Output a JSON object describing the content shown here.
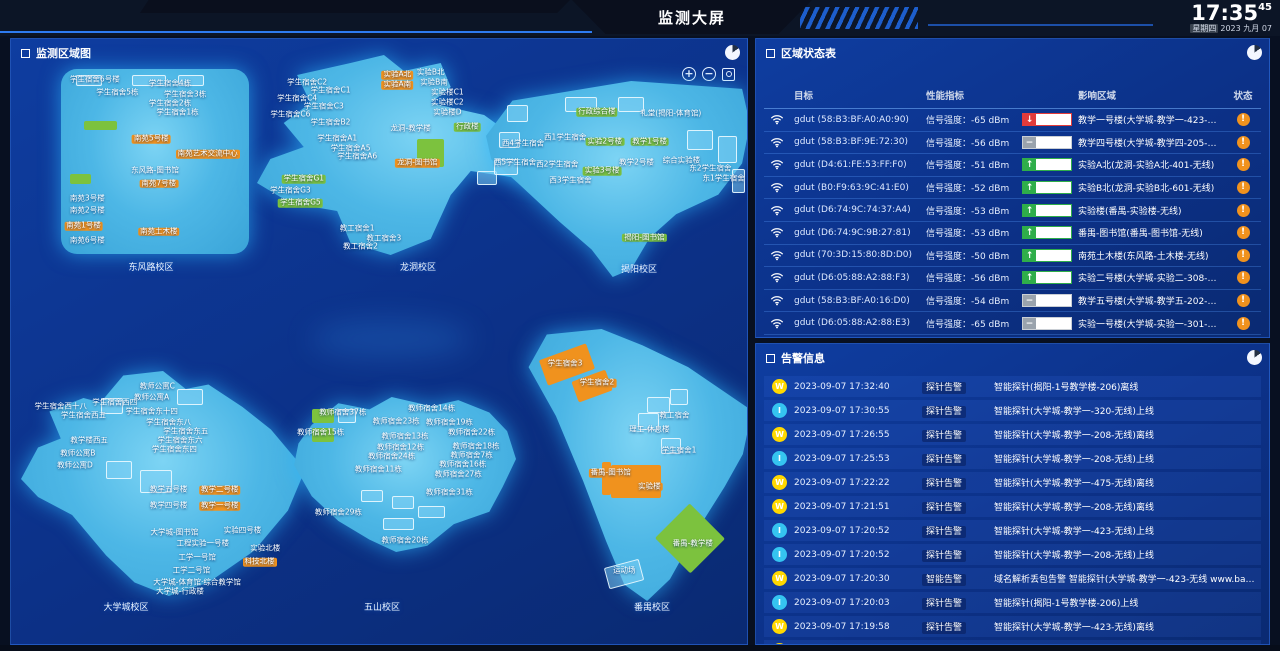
{
  "header": {
    "title": "监测大屏",
    "clock": {
      "time": "17:35",
      "seconds": "45",
      "weekday": "星期四",
      "date_rest": "2023 九月 07"
    }
  },
  "colors": {
    "orange": "#f0921e",
    "green": "#7cc23e",
    "alarm-w": "#ffd800",
    "alarm-i": "#35c4f0",
    "trend-red": "#e23b3b",
    "trend-green": "#2fae4a",
    "trend-gray": "#9aa3ad"
  },
  "map_panel": {
    "title": "监测区域图",
    "zoom_controls": {
      "zoom_in": "+",
      "zoom_out": "−",
      "fit": "fit-view"
    },
    "campuses": [
      {
        "name": "东风路校区",
        "label_pos": [
          140,
          221
        ],
        "labels": [
          [
            18,
            6,
            0,
            "学生宿舍6号楼"
          ],
          [
            58,
            8,
            0,
            "学生宿舍4栋"
          ],
          [
            30,
            13,
            0,
            "学生宿舍5栋"
          ],
          [
            66,
            14,
            0,
            "学生宿舍3栋"
          ],
          [
            58,
            19,
            0,
            "学生宿舍2栋"
          ],
          [
            62,
            24,
            0,
            "学生宿舍1栋"
          ],
          [
            48,
            38,
            1,
            "南苑5号楼"
          ],
          [
            78,
            46,
            1,
            "南苑艺术交流中心"
          ],
          [
            50,
            55,
            0,
            "东风路-图书馆"
          ],
          [
            52,
            62,
            1,
            "南苑7号楼"
          ],
          [
            14,
            70,
            0,
            "南苑3号楼"
          ],
          [
            14,
            77,
            0,
            "南苑2号楼"
          ],
          [
            12,
            85,
            1,
            "南苑1号楼"
          ],
          [
            14,
            93,
            0,
            "南苑6号楼"
          ],
          [
            52,
            88,
            1,
            "南苑土木楼"
          ]
        ],
        "rects": [
          [
            12,
            28,
            18,
            5,
            "gr"
          ],
          [
            5,
            57,
            11,
            5,
            "gr"
          ],
          [
            8,
            3,
            14,
            6,
            "o"
          ],
          [
            38,
            3,
            18,
            6,
            "o"
          ],
          [
            62,
            3,
            14,
            6,
            "o"
          ]
        ]
      },
      {
        "name": "龙洞校区",
        "label_pos": [
          407,
          221
        ],
        "labels": [
          [
            15,
            14,
            0,
            "学生宿舍C2"
          ],
          [
            22,
            18,
            0,
            "学生宿舍C1"
          ],
          [
            12,
            22,
            0,
            "学生宿舍C4"
          ],
          [
            20,
            26,
            0,
            "学生宿舍C3"
          ],
          [
            10,
            30,
            0,
            "学生宿舍C6"
          ],
          [
            42,
            10,
            1,
            "实验A北"
          ],
          [
            52,
            9,
            0,
            "实验B北"
          ],
          [
            42,
            15,
            1,
            "实验A南"
          ],
          [
            53,
            14,
            0,
            "实验B南"
          ],
          [
            57,
            19,
            0,
            "实验楼C1"
          ],
          [
            57,
            24,
            0,
            "实验楼C2"
          ],
          [
            57,
            29,
            0,
            "实验楼D"
          ],
          [
            22,
            34,
            0,
            "学生宿舍B2"
          ],
          [
            24,
            42,
            0,
            "学生宿舍A1"
          ],
          [
            28,
            47,
            0,
            "学生宿舍A5"
          ],
          [
            30,
            51,
            0,
            "学生宿舍A6"
          ],
          [
            46,
            37,
            0,
            "龙洞-教学楼"
          ],
          [
            63,
            36,
            2,
            "行政楼"
          ],
          [
            48,
            54,
            1,
            "龙洞-图书馆"
          ],
          [
            14,
            62,
            2,
            "学生宿舍G1"
          ],
          [
            10,
            68,
            0,
            "学生宿舍G3"
          ],
          [
            13,
            74,
            2,
            "学生宿舍G5"
          ],
          [
            30,
            87,
            0,
            "教工宿舍1"
          ],
          [
            38,
            92,
            0,
            "教工宿舍3"
          ],
          [
            31,
            96,
            0,
            "教工宿舍2"
          ]
        ],
        "rects": [
          [
            48,
            42,
            8,
            14,
            "gr"
          ],
          [
            72,
            48,
            7,
            8,
            "o"
          ],
          [
            81,
            52,
            7,
            8,
            "o"
          ],
          [
            89,
            58,
            6,
            7,
            "o"
          ],
          [
            66,
            58,
            6,
            7,
            "o"
          ]
        ]
      },
      {
        "name": "揭阳校区",
        "label_pos": [
          628,
          223
        ],
        "labels": [
          [
            42,
            16,
            2,
            "行政综合楼"
          ],
          [
            70,
            17,
            0,
            "礼堂(揭阳-体育馆)"
          ],
          [
            14,
            32,
            0,
            "西4学生宿舍"
          ],
          [
            30,
            29,
            0,
            "西1学生宿舍"
          ],
          [
            45,
            31,
            2,
            "实验2号楼"
          ],
          [
            62,
            31,
            2,
            "教学1号楼"
          ],
          [
            11,
            42,
            0,
            "西5学生宿舍"
          ],
          [
            27,
            43,
            0,
            "西2学生宿舍"
          ],
          [
            44,
            46,
            2,
            "实验3号楼"
          ],
          [
            57,
            42,
            0,
            "教学2号楼"
          ],
          [
            74,
            41,
            0,
            "综合实验楼"
          ],
          [
            85,
            45,
            0,
            "东2学生宿舍"
          ],
          [
            90,
            50,
            0,
            "东1学生宿舍"
          ],
          [
            32,
            51,
            0,
            "西3学生宿舍"
          ],
          [
            60,
            80,
            2,
            "揭阳-图书馆"
          ]
        ],
        "rects": [
          [
            8,
            12,
            8,
            9,
            "o"
          ],
          [
            5,
            26,
            8,
            8,
            "o"
          ],
          [
            3,
            40,
            9,
            8,
            "o"
          ],
          [
            30,
            8,
            12,
            8,
            "o"
          ],
          [
            50,
            8,
            10,
            8,
            "o"
          ],
          [
            76,
            25,
            10,
            10,
            "o"
          ],
          [
            88,
            28,
            7,
            14,
            "o"
          ],
          [
            93,
            45,
            5,
            12,
            "o"
          ]
        ]
      },
      {
        "name": "大学城校区",
        "label_pos": [
          115,
          561
        ],
        "labels": [
          [
            48,
            7,
            0,
            "教师公寓C"
          ],
          [
            46,
            12,
            0,
            "教师公寓A"
          ],
          [
            14,
            16,
            0,
            "学生宿舍西十八"
          ],
          [
            33,
            14,
            0,
            "学生宿舍西四"
          ],
          [
            22,
            20,
            0,
            "学生宿舍西五"
          ],
          [
            46,
            18,
            0,
            "学生宿舍东十四"
          ],
          [
            52,
            23,
            0,
            "学生宿舍东八"
          ],
          [
            58,
            27,
            0,
            "学生宿舍东五"
          ],
          [
            56,
            31,
            0,
            "学生宿舍东六"
          ],
          [
            54,
            35,
            0,
            "学生宿舍东四"
          ],
          [
            24,
            31,
            0,
            "教学楼西五"
          ],
          [
            20,
            37,
            0,
            "教师公寓B"
          ],
          [
            19,
            42,
            0,
            "教师公寓D"
          ],
          [
            52,
            53,
            0,
            "教学五号楼"
          ],
          [
            70,
            53,
            1,
            "教学二号楼"
          ],
          [
            52,
            60,
            0,
            "教学四号楼"
          ],
          [
            70,
            60,
            1,
            "教学一号楼"
          ],
          [
            54,
            72,
            0,
            "大学城-图书馆"
          ],
          [
            78,
            71,
            0,
            "实验四号楼"
          ],
          [
            64,
            77,
            0,
            "工程实验一号楼"
          ],
          [
            86,
            79,
            0,
            "实验北楼"
          ],
          [
            62,
            83,
            0,
            "工学一号馆"
          ],
          [
            84,
            85,
            1,
            "科技北楼"
          ],
          [
            60,
            89,
            0,
            "工学二号馆"
          ],
          [
            62,
            94,
            0,
            "大学城-体育馆·综合教学馆"
          ],
          [
            56,
            98,
            0,
            "大学城-行政楼"
          ]
        ],
        "rects": [
          [
            28,
            12,
            8,
            7,
            "o"
          ],
          [
            55,
            8,
            9,
            7,
            "o"
          ],
          [
            30,
            40,
            9,
            8,
            "o"
          ],
          [
            42,
            44,
            11,
            10,
            "o"
          ]
        ]
      },
      {
        "name": "五山校区",
        "label_pos": [
          371,
          561
        ],
        "labels": [
          [
            22,
            10,
            0,
            "教师宿舍37栋"
          ],
          [
            62,
            8,
            0,
            "教师宿舍14栋"
          ],
          [
            46,
            16,
            0,
            "教师宿舍23栋"
          ],
          [
            70,
            17,
            0,
            "教师宿舍19栋"
          ],
          [
            12,
            23,
            0,
            "教师宿舍15栋"
          ],
          [
            80,
            23,
            0,
            "教师宿舍22栋"
          ],
          [
            50,
            26,
            0,
            "教师宿舍13栋"
          ],
          [
            48,
            33,
            0,
            "教师宿舍12栋"
          ],
          [
            82,
            32,
            0,
            "教师宿舍18栋"
          ],
          [
            44,
            39,
            0,
            "教师宿舍24栋"
          ],
          [
            80,
            38,
            0,
            "教师宿舍7栋"
          ],
          [
            76,
            44,
            0,
            "教师宿舍16栋"
          ],
          [
            38,
            47,
            0,
            "教师宿舍11栋"
          ],
          [
            74,
            50,
            0,
            "教师宿舍27栋"
          ],
          [
            70,
            62,
            0,
            "教师宿舍31栋"
          ],
          [
            20,
            75,
            0,
            "教师宿舍29栋"
          ],
          [
            50,
            93,
            0,
            "教师宿舍20栋"
          ]
        ],
        "rects": [
          [
            8,
            8,
            10,
            9,
            "gr"
          ],
          [
            8,
            20,
            10,
            9,
            "gr"
          ],
          [
            20,
            8,
            8,
            9,
            "o"
          ],
          [
            30,
            60,
            10,
            8,
            "o"
          ],
          [
            44,
            64,
            10,
            8,
            "o"
          ],
          [
            56,
            70,
            12,
            8,
            "o"
          ],
          [
            40,
            78,
            14,
            8,
            "o"
          ]
        ]
      },
      {
        "name": "番禺校区",
        "label_pos": [
          641,
          561
        ],
        "labels": [
          [
            18,
            13,
            1,
            "学生宿舍3"
          ],
          [
            32,
            20,
            1,
            "学生宿舍2"
          ],
          [
            66,
            32,
            0,
            "教工宿舍"
          ],
          [
            55,
            37,
            0,
            "理工-休息楼"
          ],
          [
            68,
            45,
            0,
            "学生宿舍1"
          ],
          [
            38,
            53,
            1,
            "番禺-图书馆"
          ],
          [
            55,
            58,
            1,
            "实验楼"
          ],
          [
            74,
            79,
            2,
            "番禺-教学楼"
          ],
          [
            44,
            89,
            0,
            "运动场"
          ]
        ],
        "rects": [
          [
            8,
            8,
            22,
            10,
            "or",
            -20
          ],
          [
            22,
            17,
            16,
            8,
            "or",
            -20
          ],
          [
            38,
            50,
            22,
            12,
            "or",
            0
          ],
          [
            34,
            49,
            4,
            12,
            "or",
            0
          ],
          [
            62,
            68,
            22,
            18,
            "grd",
            0
          ],
          [
            54,
            25,
            10,
            6,
            "o"
          ],
          [
            64,
            22,
            8,
            6,
            "o"
          ],
          [
            50,
            31,
            9,
            6,
            "o"
          ],
          [
            60,
            40,
            9,
            6,
            "o"
          ],
          [
            36,
            86,
            16,
            8,
            "o",
            -15
          ]
        ]
      }
    ]
  },
  "status_panel": {
    "title": "区域状态表",
    "columns": [
      "目标",
      "性能指标",
      "影响区域",
      "状态"
    ],
    "rows": [
      {
        "target": "gdut (58:B3:BF:A0:A0:90)",
        "metric": "信号强度：-65 dBm",
        "trend": "down",
        "area": "教学一号楼(大学城-教学一-423-无线)",
        "status": "warning"
      },
      {
        "target": "gdut (58:B3:BF:9E:72:30)",
        "metric": "信号强度：-56 dBm",
        "trend": "flat",
        "area": "教学四号楼(大学城-教学四-205-无线)",
        "status": "warning"
      },
      {
        "target": "gdut (D4:61:FE:53:FF:F0)",
        "metric": "信号强度：-51 dBm",
        "trend": "up",
        "area": "实验A北(龙洞-实验A北-401-无线)",
        "status": "warning"
      },
      {
        "target": "gdut (B0:F9:63:9C:41:E0)",
        "metric": "信号强度：-52 dBm",
        "trend": "up",
        "area": "实验B北(龙洞-实验B北-601-无线)",
        "status": "warning"
      },
      {
        "target": "gdut (D6:74:9C:74:37:A4)",
        "metric": "信号强度：-53 dBm",
        "trend": "up",
        "area": "实验楼(番禺-实验楼-无线)",
        "status": "warning"
      },
      {
        "target": "gdut (D6:74:9C:9B:27:81)",
        "metric": "信号强度：-53 dBm",
        "trend": "up",
        "area": "番禺-图书馆(番禺-图书馆-无线)",
        "status": "warning"
      },
      {
        "target": "gdut (70:3D:15:80:8D:D0)",
        "metric": "信号强度：-50 dBm",
        "trend": "up",
        "area": "南苑土木楼(东风路-土木楼-无线)",
        "status": "warning"
      },
      {
        "target": "gdut (D6:05:88:A2:88:F3)",
        "metric": "信号强度：-56 dBm",
        "trend": "up",
        "area": "实验二号楼(大学城-实验二-308-无线)",
        "status": "warning"
      },
      {
        "target": "gdut (58:B3:BF:A0:16:D0)",
        "metric": "信号强度：-54 dBm",
        "trend": "flat",
        "area": "教学五号楼(大学城-教学五-202-无线)",
        "status": "warning"
      },
      {
        "target": "gdut (D6:05:88:A2:88:E3)",
        "metric": "信号强度：-65 dBm",
        "trend": "flat",
        "area": "实验一号楼(大学城-实验一-301-无线)",
        "status": "warning"
      }
    ]
  },
  "alarm_panel": {
    "title": "告警信息",
    "alarms": [
      {
        "level": "W",
        "time": "2023-09-07 17:32:40",
        "type": "探针告警",
        "message": "智能探针(揭阳-1号教学楼-206)离线"
      },
      {
        "level": "I",
        "time": "2023-09-07 17:30:55",
        "type": "探针告警",
        "message": "智能探针(大学城-教学一-320-无线)上线"
      },
      {
        "level": "W",
        "time": "2023-09-07 17:26:55",
        "type": "探针告警",
        "message": "智能探针(大学城-教学一-208-无线)离线"
      },
      {
        "level": "I",
        "time": "2023-09-07 17:25:53",
        "type": "探针告警",
        "message": "智能探针(大学城-教学一-208-无线)上线"
      },
      {
        "level": "W",
        "time": "2023-09-07 17:22:22",
        "type": "探针告警",
        "message": "智能探针(大学城-教学一-475-无线)离线"
      },
      {
        "level": "W",
        "time": "2023-09-07 17:21:51",
        "type": "探针告警",
        "message": "智能探针(大学城-教学一-208-无线)离线"
      },
      {
        "level": "I",
        "time": "2023-09-07 17:20:52",
        "type": "探针告警",
        "message": "智能探针(大学城-教学一-423-无线)上线"
      },
      {
        "level": "I",
        "time": "2023-09-07 17:20:52",
        "type": "探针告警",
        "message": "智能探针(大学城-教学一-208-无线)上线"
      },
      {
        "level": "W",
        "time": "2023-09-07 17:20:30",
        "type": "智能告警",
        "message": "域名解析丢包告警 智能探针(大学城-教学一-423-无线 www.baidu.com 丢包率触发告警 当前值:100%"
      },
      {
        "level": "I",
        "time": "2023-09-07 17:20:03",
        "type": "探针告警",
        "message": "智能探针(揭阳-1号教学楼-206)上线"
      },
      {
        "level": "W",
        "time": "2023-09-07 17:19:58",
        "type": "探针告警",
        "message": "智能探针(大学城-教学一-423-无线)离线"
      },
      {
        "level": "W",
        "time": "",
        "type": "",
        "message": ""
      }
    ]
  }
}
